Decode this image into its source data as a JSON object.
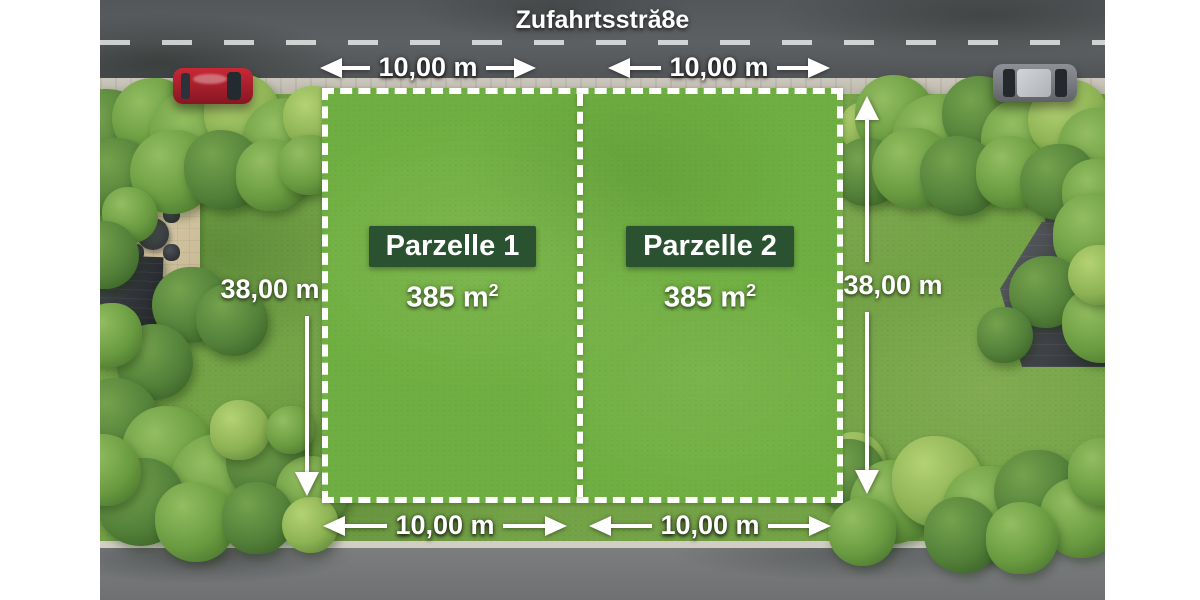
{
  "street": {
    "name": "Zufahrtsstră8e"
  },
  "parcels": [
    {
      "name": "Parzelle 1",
      "area_value": "385 m",
      "area_exponent": "2"
    },
    {
      "name": "Parzelle 2",
      "area_value": "385 m",
      "area_exponent": "2"
    }
  ],
  "dimensions": {
    "top": [
      "10,00 m",
      "10,00 m"
    ],
    "bottom": [
      "10,00 m",
      "10,00 m"
    ],
    "left": "38,00 m",
    "right": "38,00 m"
  },
  "colors": {
    "parcel_label_background": "#2a5130",
    "overlay_text": "#ffffff",
    "boundary_dash": "#ffffff"
  }
}
